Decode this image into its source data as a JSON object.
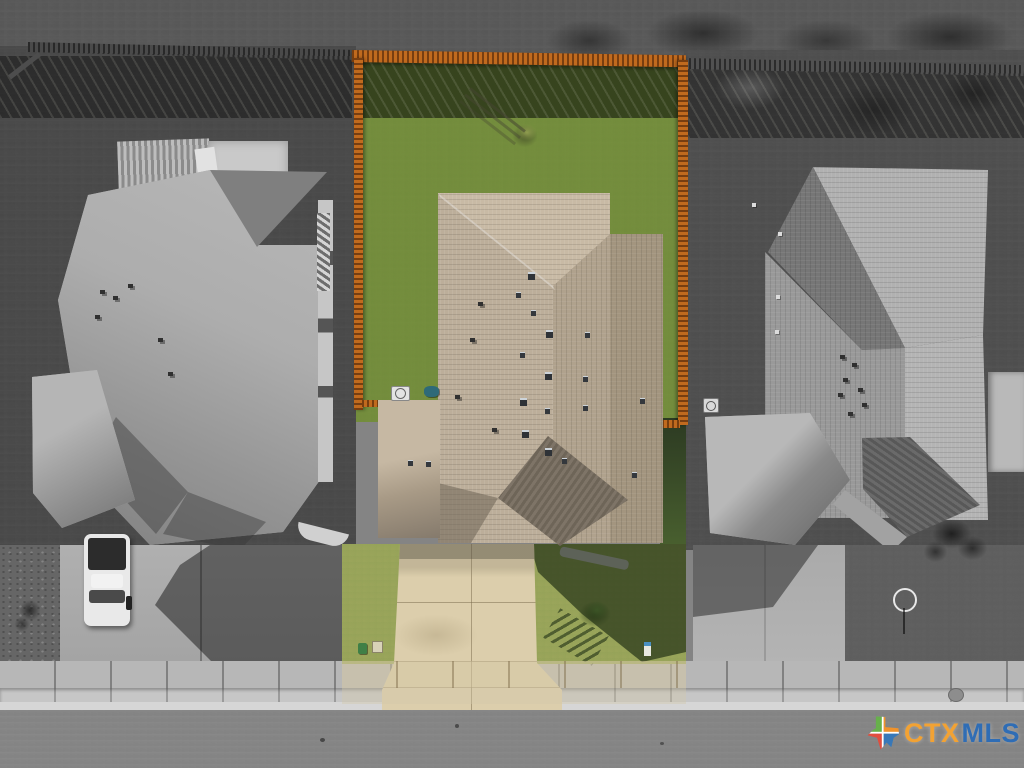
{
  "watermark": {
    "logo_icon": "texas-state-icon",
    "brand_prefix": "CTX",
    "brand_suffix": "MLS"
  },
  "palette": {
    "field_gray": "#848484",
    "fence_orange": "#c06a1e",
    "fence_orange_dark": "#8a4513",
    "dry_grass": "#c7b46e",
    "grass_green": "#7e9a4d",
    "grass_shadow": "#22371a",
    "roof_tan": "#bcae9a",
    "roof_tan_mid": "#b0a28d",
    "roof_tan_dark": "#a3957f",
    "porch_gray": "#7a7164",
    "driveway_tan": "#dcceac",
    "sidewalk_gray": "#b7b7b7",
    "curb_gray": "#c6c6c6",
    "street_gray": "#9b9b9b",
    "roof_gray_light": "#b2b2b2",
    "roof_gray_mid": "#989898",
    "roof_gray_dark": "#6f6f6f",
    "shadow_dark": "#3a3a3a",
    "truck_white": "#e9e9e9",
    "logo_green": "#67b04b",
    "logo_orange": "#f0932b",
    "logo_red": "#e04f3f",
    "logo_blue": "#3878b8",
    "text_orange": "#f2a233",
    "text_blue": "#2f6db5"
  }
}
